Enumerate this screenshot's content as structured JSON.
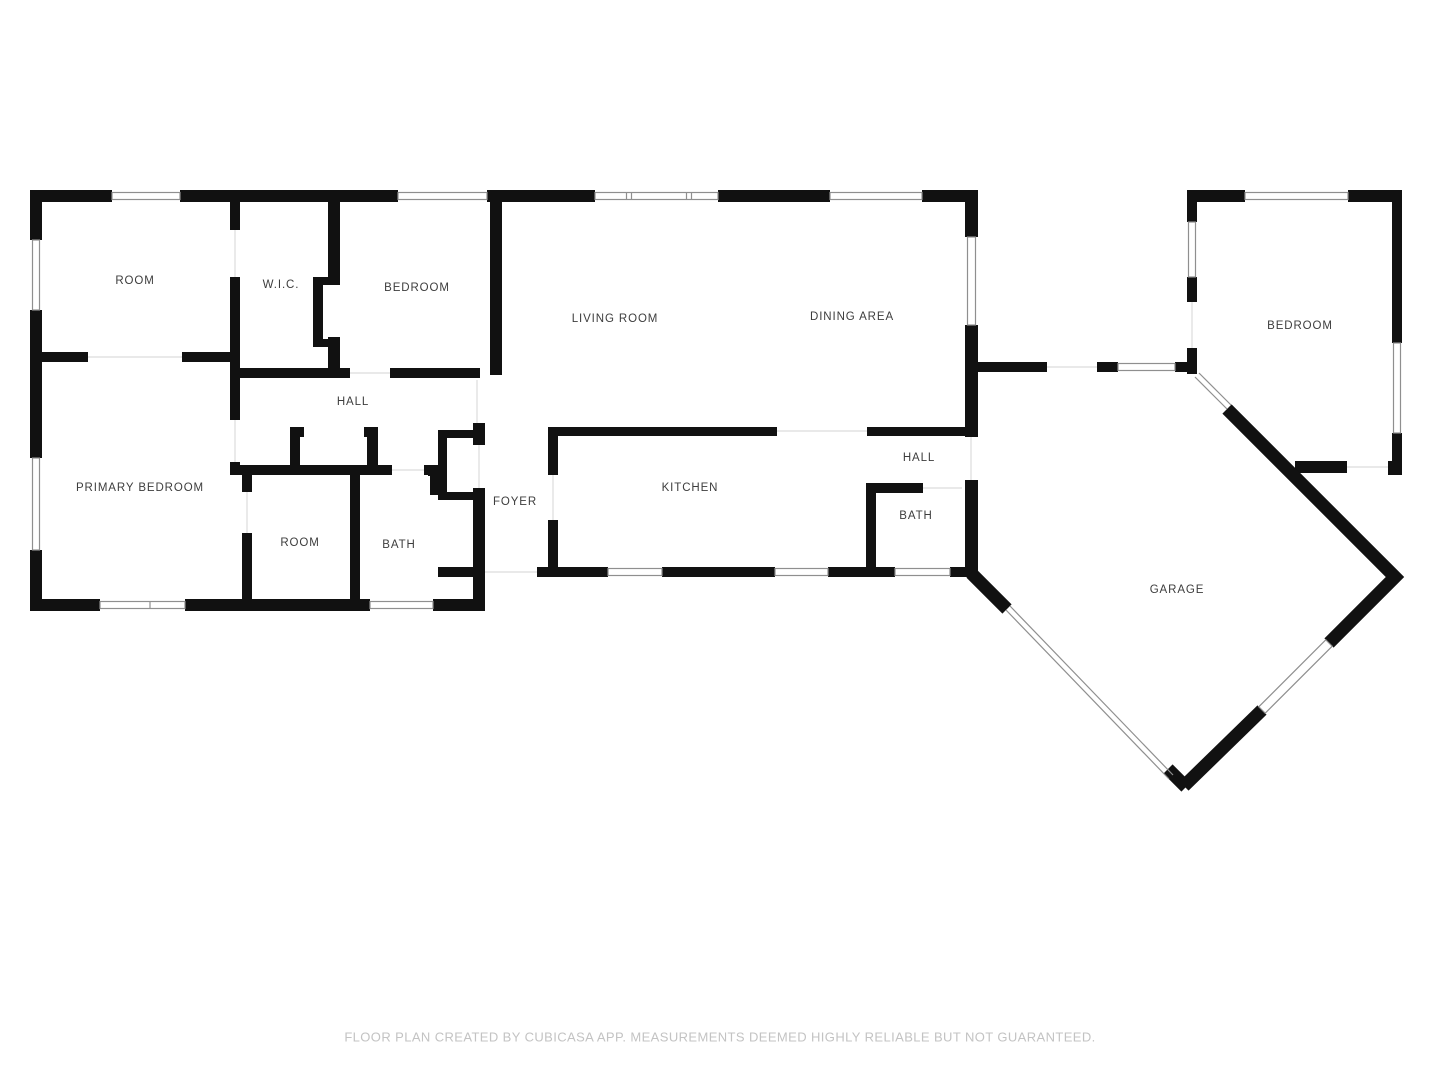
{
  "colors": {
    "wall": "#111111",
    "windowStroke": "#8f8f8f",
    "threshold": "#dcdcdc",
    "label": "#3d3d3d",
    "footer": "#c3c3c3",
    "bg": "#ffffff"
  },
  "rooms": {
    "room_tl": {
      "label": "ROOM"
    },
    "wic": {
      "label": "W.I.C."
    },
    "bedroom_top": {
      "label": "BEDROOM"
    },
    "living_room": {
      "label": "LIVING ROOM"
    },
    "dining_area": {
      "label": "DINING AREA"
    },
    "hall_main": {
      "label": "HALL"
    },
    "primary_bedroom": {
      "label": "PRIMARY BEDROOM"
    },
    "room_bottom": {
      "label": "ROOM"
    },
    "bath_main": {
      "label": "BATH"
    },
    "foyer": {
      "label": "FOYER"
    },
    "kitchen": {
      "label": "KITCHEN"
    },
    "hall_right": {
      "label": "HALL"
    },
    "bath_right": {
      "label": "BATH"
    },
    "garage": {
      "label": "GARAGE"
    },
    "bedroom_right": {
      "label": "BEDROOM"
    }
  },
  "footer": {
    "text": "FLOOR PLAN CREATED BY CUBICASA APP. MEASUREMENTS DEEMED HIGHLY RELIABLE BUT NOT GUARANTEED."
  }
}
